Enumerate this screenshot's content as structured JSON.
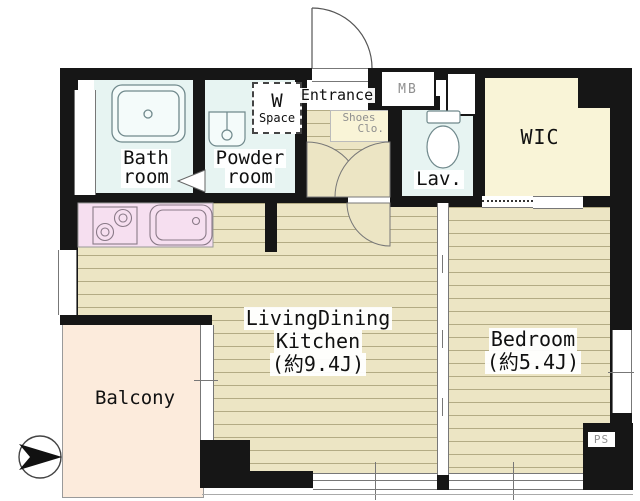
{
  "rooms": {
    "bath": {
      "line1": "Bath",
      "line2": "room"
    },
    "powder": {
      "line1": "Powder",
      "line2": "room"
    },
    "washer_space": {
      "line1": "W",
      "line2": "Space"
    },
    "entrance": {
      "label": "Entrance"
    },
    "meter_box": {
      "label": "MB"
    },
    "shoes_closet": {
      "line1": "Shoes",
      "line2": "Clo."
    },
    "lavatory": {
      "label": "Lav."
    },
    "wic": {
      "label": "WIC"
    },
    "ldk": {
      "line1": "LivingDining",
      "line2": "Kitchen",
      "line3": "(約9.4J)"
    },
    "bedroom": {
      "line1": "Bedroom",
      "line2": "(約5.4J)"
    },
    "balcony": {
      "label": "Balcony"
    },
    "pipe_space": {
      "label": "PS"
    }
  },
  "colors": {
    "wall": "#161616",
    "tatami_floor": "#ece5c4",
    "floor_stripe": "#b3ab84",
    "wet_room": "#e7f4f2",
    "closet": "#f9f4d7",
    "kitchen_counter": "#f6dff0",
    "balcony": "#fcebdc",
    "label_gray": "#8f8f8f"
  }
}
